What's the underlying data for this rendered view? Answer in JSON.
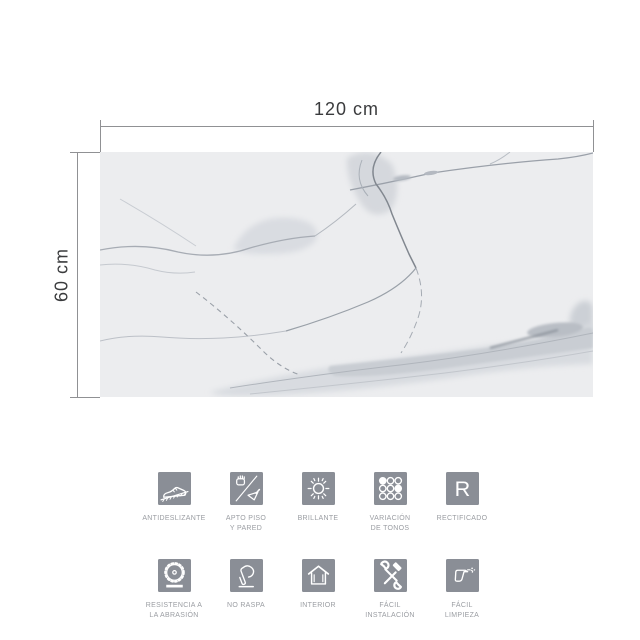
{
  "colors": {
    "background": "#ffffff",
    "tile_base": "#ecedef",
    "dimension_line": "#909194",
    "dimension_text": "#3a3b3d",
    "icon_bg": "#8a8e96",
    "icon_glyph": "#ffffff",
    "label": "#9a9da2"
  },
  "tile": {
    "width_label": "120 cm",
    "height_label": "60 cm",
    "material": "white marble with gray veins"
  },
  "features": {
    "rows": [
      {
        "items": [
          {
            "name": "antideslizante",
            "icon": "shoe-slope-icon",
            "line1": "ANTIDESLIZANTE",
            "line2": ""
          },
          {
            "name": "apto-piso-y-pared",
            "icon": "hand-trowel-icon",
            "line1": "APTO PISO",
            "line2": "Y PARED"
          },
          {
            "name": "brillante",
            "icon": "sun-icon",
            "line1": "BRILLANTE",
            "line2": ""
          },
          {
            "name": "variacion-de-tonos",
            "icon": "tone-dots-icon",
            "line1": "VARIACIÓN",
            "line2": "DE TONOS"
          },
          {
            "name": "rectificado",
            "icon": "letter-r-icon",
            "line1": "RECTIFICADO",
            "line2": ""
          }
        ]
      },
      {
        "items": [
          {
            "name": "resistencia-a-la-abrasion",
            "icon": "saw-blade-icon",
            "line1": "RESISTENCIA A",
            "line2": "LA ABRASIÓN"
          },
          {
            "name": "no-raspa",
            "icon": "hand-press-icon",
            "line1": "NO RASPA",
            "line2": ""
          },
          {
            "name": "interior",
            "icon": "house-icon",
            "line1": "INTERIOR",
            "line2": ""
          },
          {
            "name": "facil-instalacion",
            "icon": "tools-icon",
            "line1": "FÁCIL",
            "line2": "INSTALACIÓN"
          },
          {
            "name": "facil-limpieza",
            "icon": "spray-gun-icon",
            "line1": "FÁCIL",
            "line2": "LIMPIEZA"
          }
        ]
      }
    ]
  }
}
